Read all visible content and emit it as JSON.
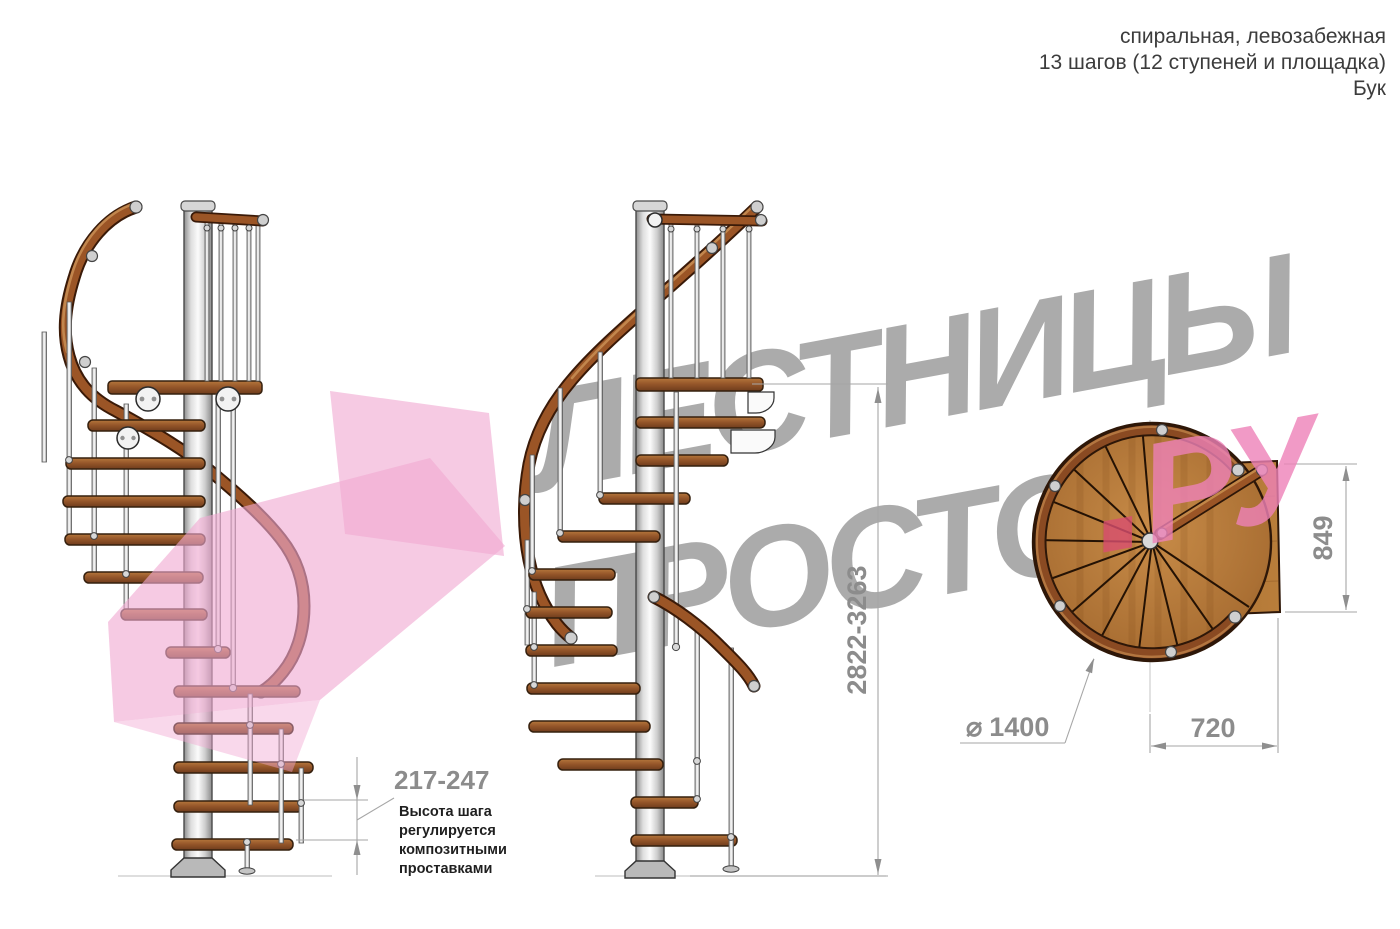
{
  "header": {
    "line1": "спиральная, левозабежная",
    "line2": "13 шагов (12 ступеней и площадка)",
    "line3": "Бук"
  },
  "watermark": {
    "brand_top": "ЛЕСТНИЦЫ",
    "brand_bottom": "ПРОСТО",
    "brand_suffix_dot": ".",
    "brand_suffix_letters": "РУ"
  },
  "dimensions": {
    "step_height": "217-247",
    "step_height_note_lines": [
      "Высота шага",
      "регулируется",
      "композитными",
      "проставками"
    ],
    "total_height": "2822-3263",
    "landing_depth": "849",
    "landing_width": "720",
    "diameter_symbol": "⌀",
    "diameter": "1400"
  },
  "colors": {
    "wood": "#9a5a28",
    "rail": "#8a4a22",
    "metal": "#d9d9d9",
    "dimension_gray": "#8c8c8c",
    "watermark_gray": "#9d9d9d",
    "watermark_pink": "#ee82b8",
    "logo_pink": "#f1a9d2"
  }
}
